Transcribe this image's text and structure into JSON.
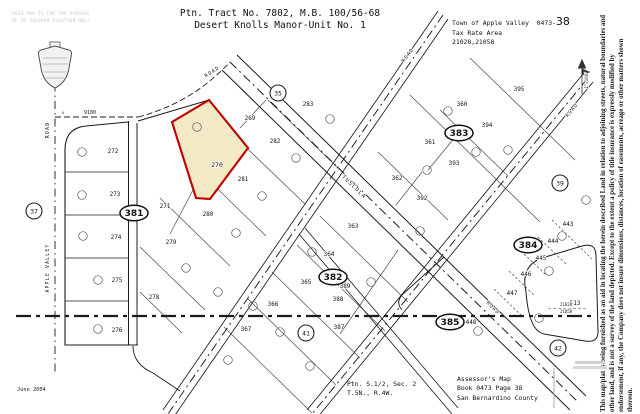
{
  "header": {
    "title_line1": "Ptn. Tract No. 7802, M.B. 100/56-68",
    "title_line2": "Desert Knolls Manor-Unit No. 1",
    "agency_line1": "Town of Apple Valley",
    "agency_code_prefix": "0473-",
    "agency_code_suffix": "38",
    "agency_line2": "Tax Rate Area",
    "agency_line3": "21028,21058",
    "faint_line1": "THIS MAP IS FOR THE PURPOSE",
    "faint_line2": "OF AD VALOREM TAXATION ONLY"
  },
  "footer": {
    "date": "June 2004",
    "section_line1": "Ptn. S.1/2, Sec. 2",
    "section_line2": "T.5N., R.4W.",
    "assessor_line1": "Assessor's Map",
    "assessor_line2": "Book 0473 Page 38",
    "assessor_line3": "San Bernardino County"
  },
  "disclaimer": "This map/plat is being furnished as an aid in locating the herein described Land in relation to adjoining streets, natural boundaries and other land, and is not a survey of the land depicted. Except to the extent a policy of title insurance is expressly modified by endorsement, if any, the Company does not insure dimensions, distances, location of easements, acreage or other matters shown thereon.",
  "map": {
    "highlight_parcel": {
      "label": "270",
      "fill": "#f4e9c5",
      "stroke": "#c00000",
      "label_x": 217,
      "label_y": 167
    },
    "parcel_labels": [
      {
        "t": "269",
        "x": 250,
        "y": 120
      },
      {
        "t": "271",
        "x": 165,
        "y": 208
      },
      {
        "t": "272",
        "x": 113,
        "y": 153
      },
      {
        "t": "273",
        "x": 115,
        "y": 196
      },
      {
        "t": "274",
        "x": 116,
        "y": 239
      },
      {
        "t": "275",
        "x": 117,
        "y": 282
      },
      {
        "t": "276",
        "x": 117,
        "y": 332
      },
      {
        "t": "278",
        "x": 154,
        "y": 299
      },
      {
        "t": "279",
        "x": 171,
        "y": 244
      },
      {
        "t": "280",
        "x": 208,
        "y": 216
      },
      {
        "t": "281",
        "x": 243,
        "y": 181
      },
      {
        "t": "282",
        "x": 275,
        "y": 143
      },
      {
        "t": "283",
        "x": 308,
        "y": 106
      },
      {
        "t": "360",
        "x": 462,
        "y": 106
      },
      {
        "t": "361",
        "x": 430,
        "y": 144
      },
      {
        "t": "362",
        "x": 397,
        "y": 180
      },
      {
        "t": "363",
        "x": 353,
        "y": 228
      },
      {
        "t": "364",
        "x": 329,
        "y": 256
      },
      {
        "t": "365",
        "x": 306,
        "y": 284
      },
      {
        "t": "366",
        "x": 273,
        "y": 306
      },
      {
        "t": "367",
        "x": 246,
        "y": 331
      },
      {
        "t": "387",
        "x": 339,
        "y": 329
      },
      {
        "t": "388",
        "x": 338,
        "y": 301
      },
      {
        "t": "389",
        "x": 345,
        "y": 288
      },
      {
        "t": "392",
        "x": 422,
        "y": 200
      },
      {
        "t": "393",
        "x": 454,
        "y": 165
      },
      {
        "t": "394",
        "x": 487,
        "y": 127
      },
      {
        "t": "395",
        "x": 519,
        "y": 91
      },
      {
        "t": "443",
        "x": 568,
        "y": 226
      },
      {
        "t": "444",
        "x": 553,
        "y": 243
      },
      {
        "t": "445",
        "x": 541,
        "y": 260
      },
      {
        "t": "446",
        "x": 526,
        "y": 276
      },
      {
        "t": "447",
        "x": 512,
        "y": 295
      },
      {
        "t": "448",
        "x": 471,
        "y": 324
      },
      {
        "t": "513",
        "x": 575,
        "y": 305
      }
    ],
    "block_ellipses": [
      {
        "t": "381",
        "x": 134,
        "y": 213
      },
      {
        "t": "382",
        "x": 333,
        "y": 277
      },
      {
        "t": "383",
        "x": 459,
        "y": 133
      },
      {
        "t": "384",
        "x": 528,
        "y": 245
      },
      {
        "t": "385",
        "x": 450,
        "y": 322
      }
    ],
    "street_circles": [
      {
        "t": "37",
        "x": 34,
        "y": 211
      },
      {
        "t": "35",
        "x": 278,
        "y": 93
      },
      {
        "t": "39",
        "x": 560,
        "y": 183
      },
      {
        "t": "41",
        "x": 306,
        "y": 333
      },
      {
        "t": "42",
        "x": 558,
        "y": 348
      }
    ],
    "road_labels": [
      {
        "t": "ROAD",
        "x": 213,
        "y": 73,
        "r": -33,
        "s": 5
      },
      {
        "t": "TUSCOLA",
        "x": 353,
        "y": 188,
        "r": 44,
        "s": 5.5
      },
      {
        "t": "ROAD",
        "x": 409,
        "y": 56,
        "r": -53,
        "s": 5
      },
      {
        "t": "ROAD",
        "x": 573,
        "y": 111,
        "r": -51,
        "s": 5
      },
      {
        "t": "ROAD",
        "x": 492,
        "y": 309,
        "r": 44,
        "s": 5
      },
      {
        "t": "ROAD",
        "x": 49,
        "y": 130,
        "r": -90,
        "s": 5
      },
      {
        "t": "APPLE VALLEY",
        "x": 49,
        "y": 268,
        "r": -90,
        "s": 4.8
      }
    ],
    "misc_labels": [
      {
        "t": "9100",
        "x": 90,
        "y": 114,
        "s": 5
      },
      {
        "t": "x",
        "x": 63,
        "y": 114,
        "s": 4
      },
      {
        "t": "21028",
        "x": 566,
        "y": 306,
        "s": 4
      },
      {
        "t": "21058",
        "x": 566,
        "y": 313,
        "s": 4
      },
      {
        "t": "1\"=100'",
        "x": 588,
        "y": 80,
        "r": -90,
        "s": 4
      }
    ],
    "lot_circles": [
      [
        82,
        152
      ],
      [
        82,
        195
      ],
      [
        83,
        236
      ],
      [
        98,
        280
      ],
      [
        98,
        329
      ],
      [
        197,
        127
      ],
      [
        296,
        158
      ],
      [
        330,
        119
      ],
      [
        262,
        196
      ],
      [
        236,
        233
      ],
      [
        186,
        268
      ],
      [
        218,
        292
      ],
      [
        253,
        306
      ],
      [
        280,
        332
      ],
      [
        312,
        252
      ],
      [
        339,
        274
      ],
      [
        371,
        282
      ],
      [
        420,
        231
      ],
      [
        448,
        111
      ],
      [
        476,
        152
      ],
      [
        508,
        150
      ],
      [
        427,
        170
      ],
      [
        549,
        271
      ],
      [
        562,
        236
      ],
      [
        478,
        331
      ],
      [
        539,
        318
      ],
      [
        310,
        366
      ],
      [
        228,
        360
      ],
      [
        586,
        200
      ]
    ]
  }
}
